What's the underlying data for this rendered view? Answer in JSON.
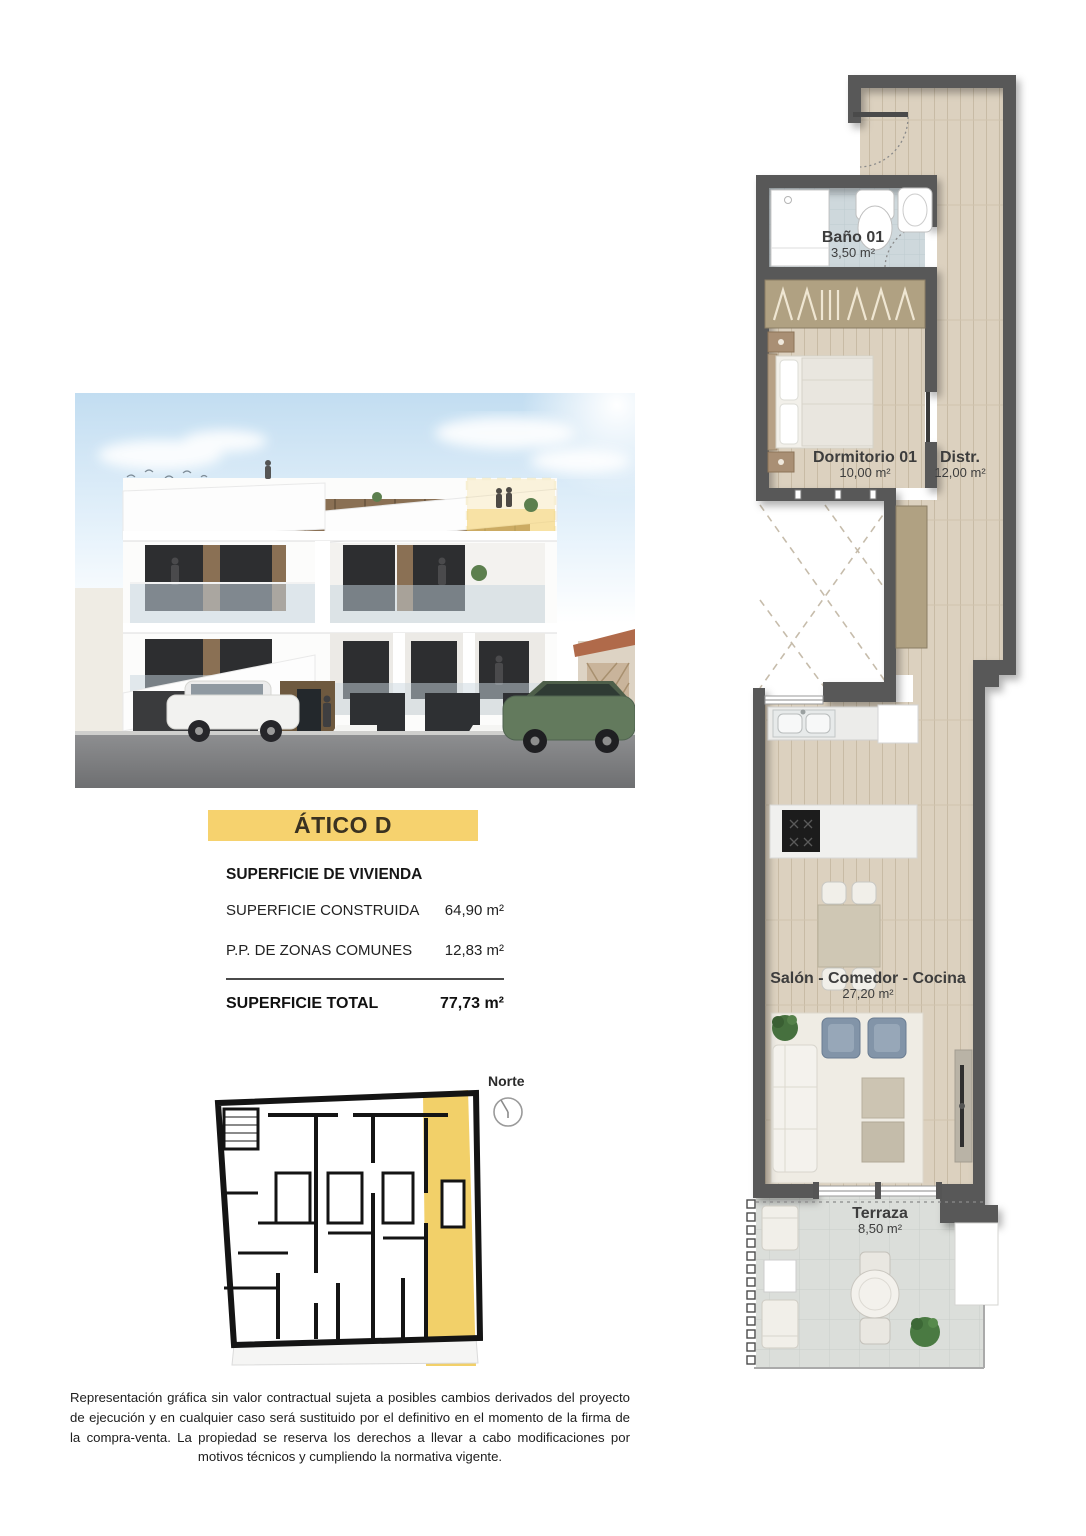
{
  "unit": {
    "banner": {
      "label": "ÁTICO D",
      "color": "#f6d26e"
    }
  },
  "surface_table": {
    "header": "SUPERFICIE DE VIVIENDA",
    "rows": [
      {
        "label": "SUPERFICIE CONSTRUIDA",
        "value": "64,90 m²"
      },
      {
        "label": "P.P. DE ZONAS COMUNES",
        "value": "12,83 m²"
      }
    ],
    "total": {
      "label": "SUPERFICIE TOTAL",
      "value": "77,73 m²"
    }
  },
  "key_plan": {
    "north_label": "Norte",
    "highlight_color": "#f2d069"
  },
  "floor_plan": {
    "rooms": [
      {
        "name": "Baño 01",
        "area": "3,50 m²"
      },
      {
        "name": "Dormitorio 01",
        "area": "10,00 m²"
      },
      {
        "name": "Distr.",
        "area": "12,00 m²"
      },
      {
        "name": "Salón - Comedor - Cocina",
        "area": "27,20 m²"
      },
      {
        "name": "Terraza",
        "area": "8,50 m²"
      }
    ],
    "colors": {
      "wall": "#595959",
      "wood_floor": "#dcd1bf",
      "bath_floor": "#ced8dc",
      "terrace_floor": "#dbdeda",
      "wardrobe": "#b0a182"
    }
  },
  "disclaimer": "Representación gráfica sin valor contractual sujeta a posibles cambios derivados del proyecto de ejecución y en cualquier caso será sustituido por el definitivo en el momento de la firma de la compra-venta. La propiedad se reserva los derechos a llevar a cabo modificaciones por motivos técnicos y cumpliendo la normativa vigente."
}
